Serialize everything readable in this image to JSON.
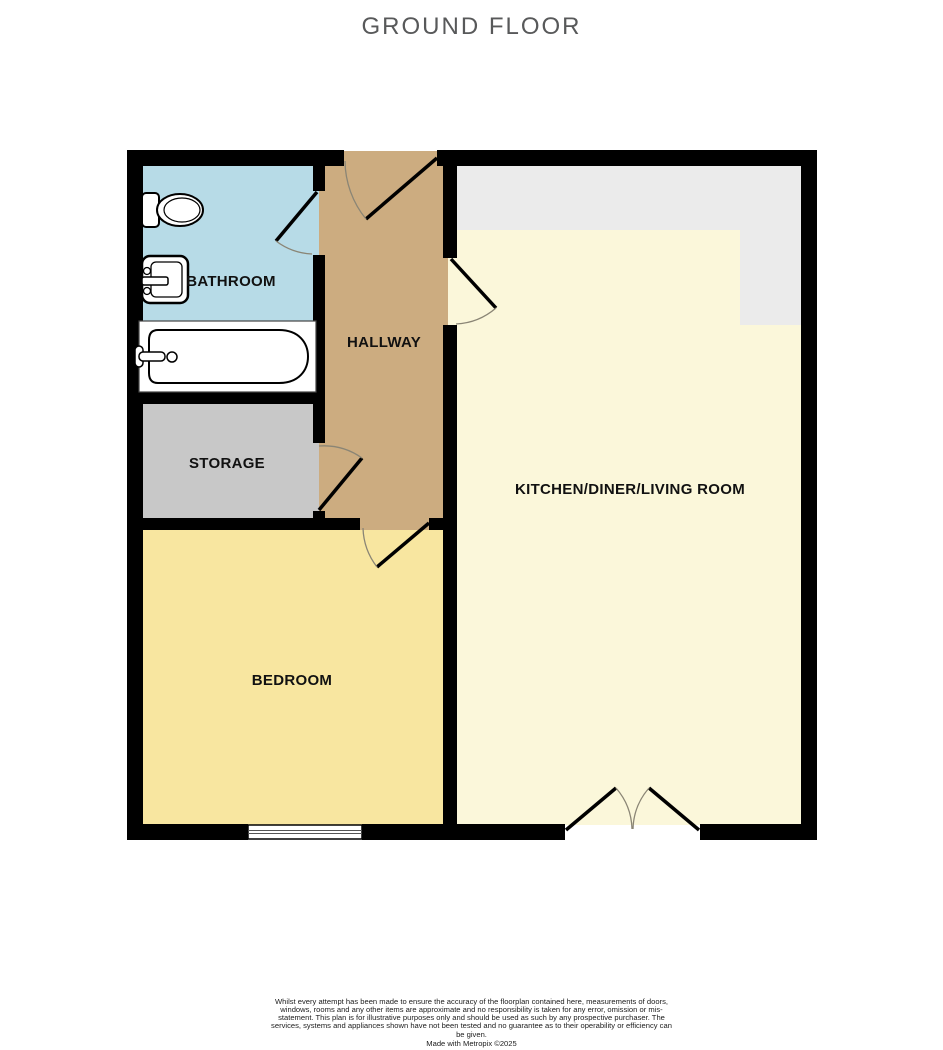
{
  "title": "GROUND FLOOR",
  "floorplan": {
    "wall_color": "#000000",
    "rooms": [
      {
        "name": "bathroom",
        "label": "BATHROOM",
        "color": "#b7dbe7"
      },
      {
        "name": "hallway",
        "label": "HALLWAY",
        "color": "#ccac80"
      },
      {
        "name": "storage",
        "label": "STORAGE",
        "color": "#c8c8c8"
      },
      {
        "name": "bedroom",
        "label": "BEDROOM",
        "color": "#f8e6a0"
      },
      {
        "name": "kitchen-diner-living-room",
        "label": "KITCHEN/DINER/LIVING ROOM",
        "color": "#fbf7da"
      }
    ],
    "counter_color": "#ebebeb",
    "symbols": [
      "toilet",
      "sink",
      "bathtub",
      "worktop",
      "window",
      "single-door",
      "double-door"
    ]
  },
  "footer": {
    "disclaimer": "Whilst every attempt has been made to ensure the accuracy of the floorplan contained here, measurements of doors, windows, rooms and any other items are approximate and no responsibility is taken for any error, omission or mis-statement. This plan is for illustrative purposes only and should be used as such by any prospective purchaser. The services, systems and appliances shown have not been tested and no guarantee as to their operability or efficiency can be given.",
    "credit": "Made with Metropix ©2025"
  }
}
